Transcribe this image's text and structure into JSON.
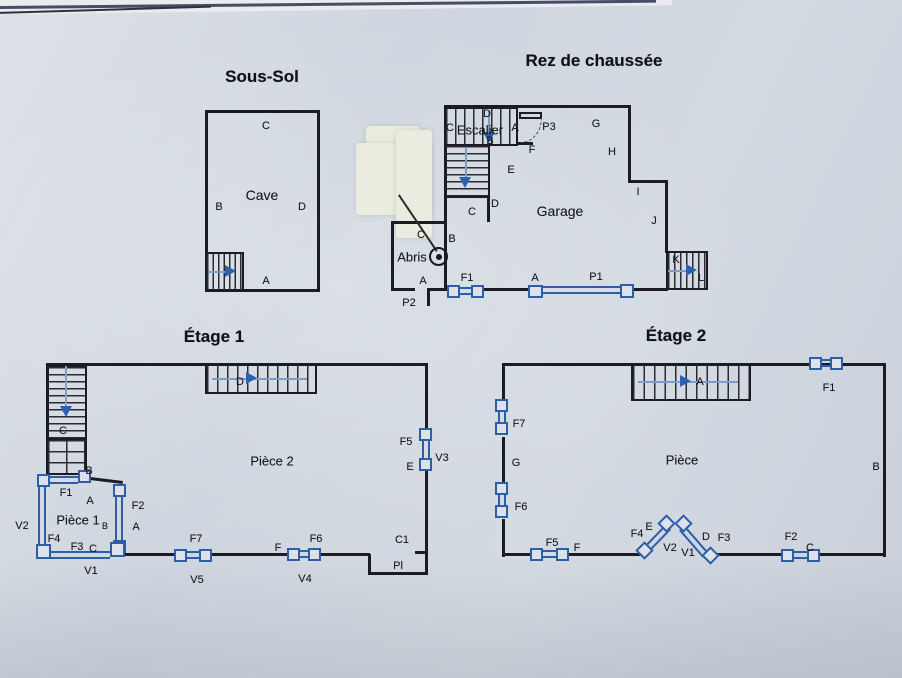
{
  "photo": {
    "description": "Photograph of a paper sheet with four hand-drafted floor plans",
    "paper_color": "#d1d7e0",
    "wall_color": "#1c1c20",
    "symbol_blue": "#2e5ea8"
  },
  "plans": {
    "sous_sol": {
      "title": "Sous-Sol",
      "room": "Cave",
      "wall_a": "A",
      "wall_b": "B",
      "wall_c": "C",
      "wall_d": "D"
    },
    "rez": {
      "title": "Rez de chaussée",
      "escalier": {
        "name": "Escalier",
        "wall_a": "A",
        "wall_b": "B",
        "wall_c": "C",
        "wall_d": "D"
      },
      "door_p3": "P3",
      "wall_e": "E",
      "wall_f": "F",
      "wall_g": "G",
      "wall_h": "H",
      "wall_i": "I",
      "wall_j": "J",
      "inner_c": "C",
      "inner_d": "D",
      "garage": "Garage",
      "wall_b": "B",
      "abris": {
        "name": "Abris",
        "wall_a": "A",
        "wall_c": "C"
      },
      "door_p2": "P2",
      "window_f1": "F1",
      "door_a": "A",
      "door_p1": "P1",
      "stair_k": "K",
      "stair_l": "L"
    },
    "etage1": {
      "title": "Étage 1",
      "stair_c": "C",
      "stair_d": "D",
      "wall_b": "B",
      "piece2": "Pièce 2",
      "piece1": "Pièce 1",
      "piece1_sub": "B",
      "window_f1": "F1",
      "wall_a_top": "A",
      "window_f2": "F2",
      "wall_a_right": "A",
      "shutter_v2": "V2",
      "window_f4": "F4",
      "window_f3": "F3",
      "wall_c": "C",
      "shutter_v1": "V1",
      "window_f7": "F7",
      "shutter_v5": "V5",
      "wall_f": "F",
      "window_f6": "F6",
      "shutter_v4": "V4",
      "window_f5": "F5",
      "wall_e": "E",
      "shutter_v3": "V3",
      "closet_c1": "C1",
      "closet_pl": "Pl"
    },
    "etage2": {
      "title": "Étage 2",
      "stair_a": "A",
      "window_f1": "F1",
      "window_f7": "F7",
      "wall_g": "G",
      "window_f6": "F6",
      "room": "Pièce",
      "wall_b": "B",
      "window_f5": "F5",
      "wall_f": "F",
      "window_f4": "F4",
      "wall_e": "E",
      "shutter_v2": "V2",
      "shutter_v1": "V1",
      "wall_d": "D",
      "window_f3": "F3",
      "window_f2": "F2",
      "wall_c": "C"
    }
  }
}
